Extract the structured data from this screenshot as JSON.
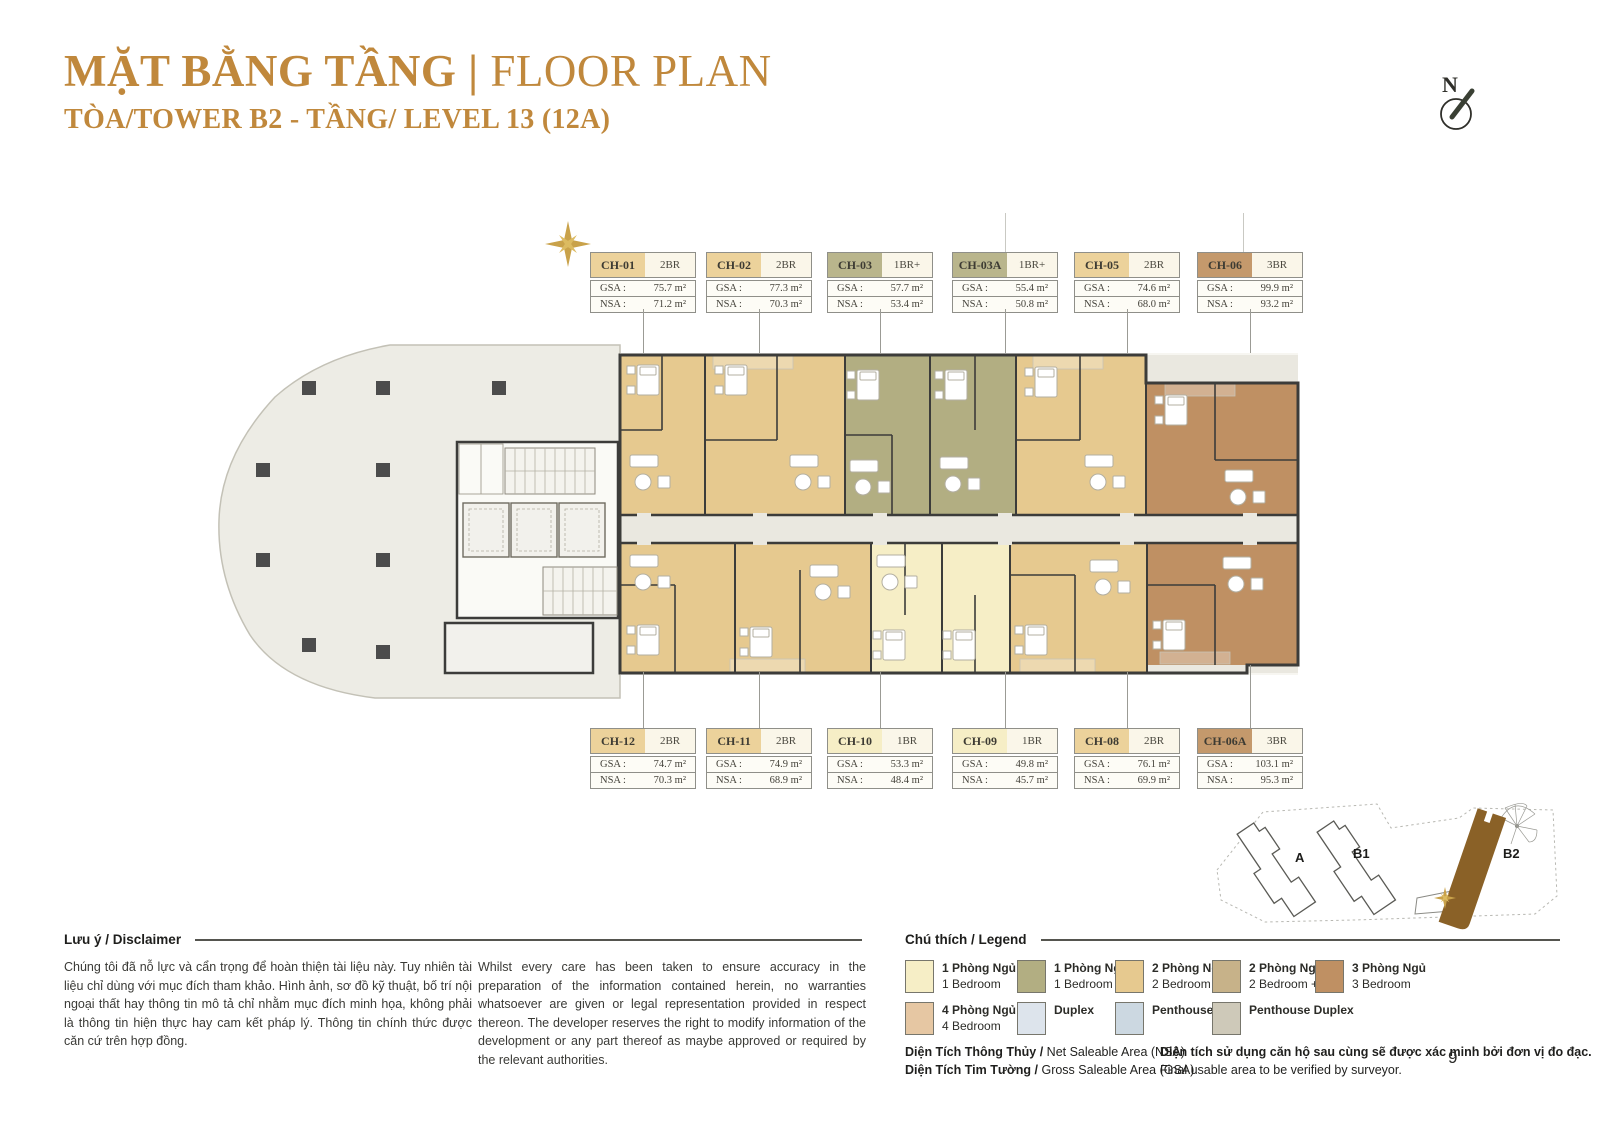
{
  "theme": {
    "accent": "#c0883c",
    "br1": "#f6eec6",
    "br1p": "#b2ae82",
    "br2": "#e6c98f",
    "br2p": "#c7b289",
    "br3": "#bf9063",
    "br4": "#e6c7a3",
    "duplex": "#dde4ec",
    "penthouse": "#ccd8e1",
    "penthouseDuplex": "#cec9b9",
    "corridor": "#eae8e0",
    "podium": "#edece5",
    "wall": "#3c3c3a",
    "b2fill": "#8a6127",
    "gold": "#c9a24a"
  },
  "header": {
    "title_vi": "MẶT BẰNG TẦNG",
    "divider": " | ",
    "title_en": "FLOOR PLAN",
    "subtitle": "TÒA/TOWER B2 - TẦNG/ LEVEL 13 (12A)"
  },
  "compass": {
    "label": "N"
  },
  "cards": {
    "labels": {
      "gsa": "GSA :",
      "nsa": "NSA :"
    },
    "top": [
      {
        "id": "CH-01",
        "type": "2BR",
        "gsa": "75.7 m²",
        "nsa": "71.2 m²",
        "color": "#ecd29b"
      },
      {
        "id": "CH-02",
        "type": "2BR",
        "gsa": "77.3 m²",
        "nsa": "70.3 m²",
        "color": "#ecd29b"
      },
      {
        "id": "CH-03",
        "type": "1BR+",
        "gsa": "57.7 m²",
        "nsa": "53.4 m²",
        "color": "#b9b58c"
      },
      {
        "id": "CH-03A",
        "type": "1BR+",
        "gsa": "55.4 m²",
        "nsa": "50.8 m²",
        "color": "#b9b58c"
      },
      {
        "id": "CH-05",
        "type": "2BR",
        "gsa": "74.6 m²",
        "nsa": "68.0 m²",
        "color": "#ecd29b"
      },
      {
        "id": "CH-06",
        "type": "3BR",
        "gsa": "99.9 m²",
        "nsa": "93.2 m²",
        "color": "#c4996c"
      }
    ],
    "bottom": [
      {
        "id": "CH-12",
        "type": "2BR",
        "gsa": "74.7 m²",
        "nsa": "70.3 m²",
        "color": "#ecd29b"
      },
      {
        "id": "CH-11",
        "type": "2BR",
        "gsa": "74.9 m²",
        "nsa": "68.9 m²",
        "color": "#ecd29b"
      },
      {
        "id": "CH-10",
        "type": "1BR",
        "gsa": "53.3 m²",
        "nsa": "48.4 m²",
        "color": "#f6eec6"
      },
      {
        "id": "CH-09",
        "type": "1BR",
        "gsa": "49.8 m²",
        "nsa": "45.7 m²",
        "color": "#f6eec6"
      },
      {
        "id": "CH-08",
        "type": "2BR",
        "gsa": "76.1 m²",
        "nsa": "69.9 m²",
        "color": "#ecd29b"
      },
      {
        "id": "CH-06A",
        "type": "3BR",
        "gsa": "103.1 m²",
        "nsa": "95.3 m²",
        "color": "#c4996c"
      }
    ]
  },
  "disclaimer": {
    "heading": "Lưu ý / Disclaimer",
    "text_vi": "Chúng tôi đã nỗ lực và cẩn trọng để hoàn thiện tài liệu này. Tuy nhiên tài liệu chỉ dùng với mục đích tham khảo. Hình ảnh, sơ đồ kỹ thuật, bố trí nội ngoại thất hay thông tin mô tả chỉ nhằm mục đích minh họa, không phải là thông tin hiện thực hay cam kết pháp lý. Thông tin chính thức được căn cứ trên hợp đồng.",
    "text_en": "Whilst every care has been taken to ensure accuracy in the preparation of the information contained herein, no warranties whatsoever are given or legal representation provided in respect thereon. The developer reserves the right to modify information of the development or any part thereof as maybe approved or required by the relevant authorities."
  },
  "legend": {
    "heading": "Chú thích / Legend",
    "items": [
      {
        "vi": "1 Phòng Ngủ",
        "en": "1 Bedroom",
        "color": "#f6eec6"
      },
      {
        "vi": "1 Phòng Ngủ +",
        "en": "1 Bedroom +",
        "color": "#b2ae82"
      },
      {
        "vi": "2 Phòng Ngủ",
        "en": "2 Bedroom",
        "color": "#e6c98f"
      },
      {
        "vi": "2 Phòng Ngủ +",
        "en": "2 Bedroom +",
        "color": "#c7b289"
      },
      {
        "vi": "3 Phòng Ngủ",
        "en": "3 Bedroom",
        "color": "#bf9063"
      },
      {
        "vi": "4 Phòng Ngủ",
        "en": "4 Bedroom",
        "color": "#e6c7a3"
      },
      {
        "vi": "Duplex",
        "en": "",
        "color": "#dde4ec"
      },
      {
        "vi": "Penthouse",
        "en": "",
        "color": "#ccd8e1"
      },
      {
        "vi": "Penthouse Duplex",
        "en": "",
        "color": "#cec9b9"
      }
    ],
    "nsa_note_bold": "Diện Tích Thông Thủy /",
    "nsa_note": " Net Saleable Area (NSA)",
    "gsa_note_bold": "Diện Tích Tim Tường /",
    "gsa_note": " Gross Saleable Area (GSA)",
    "surveyor_vi": "Diện tích sử dụng căn hộ sau cùng sẽ được xác minh bởi đơn vị đo đạc.",
    "surveyor_en": "Final usable area to be verified by surveyor."
  },
  "minimap": {
    "towers": [
      {
        "label": "A"
      },
      {
        "label": "B1"
      },
      {
        "label": "B2"
      }
    ],
    "highlighted": "B2"
  },
  "page": {
    "number": "9"
  }
}
